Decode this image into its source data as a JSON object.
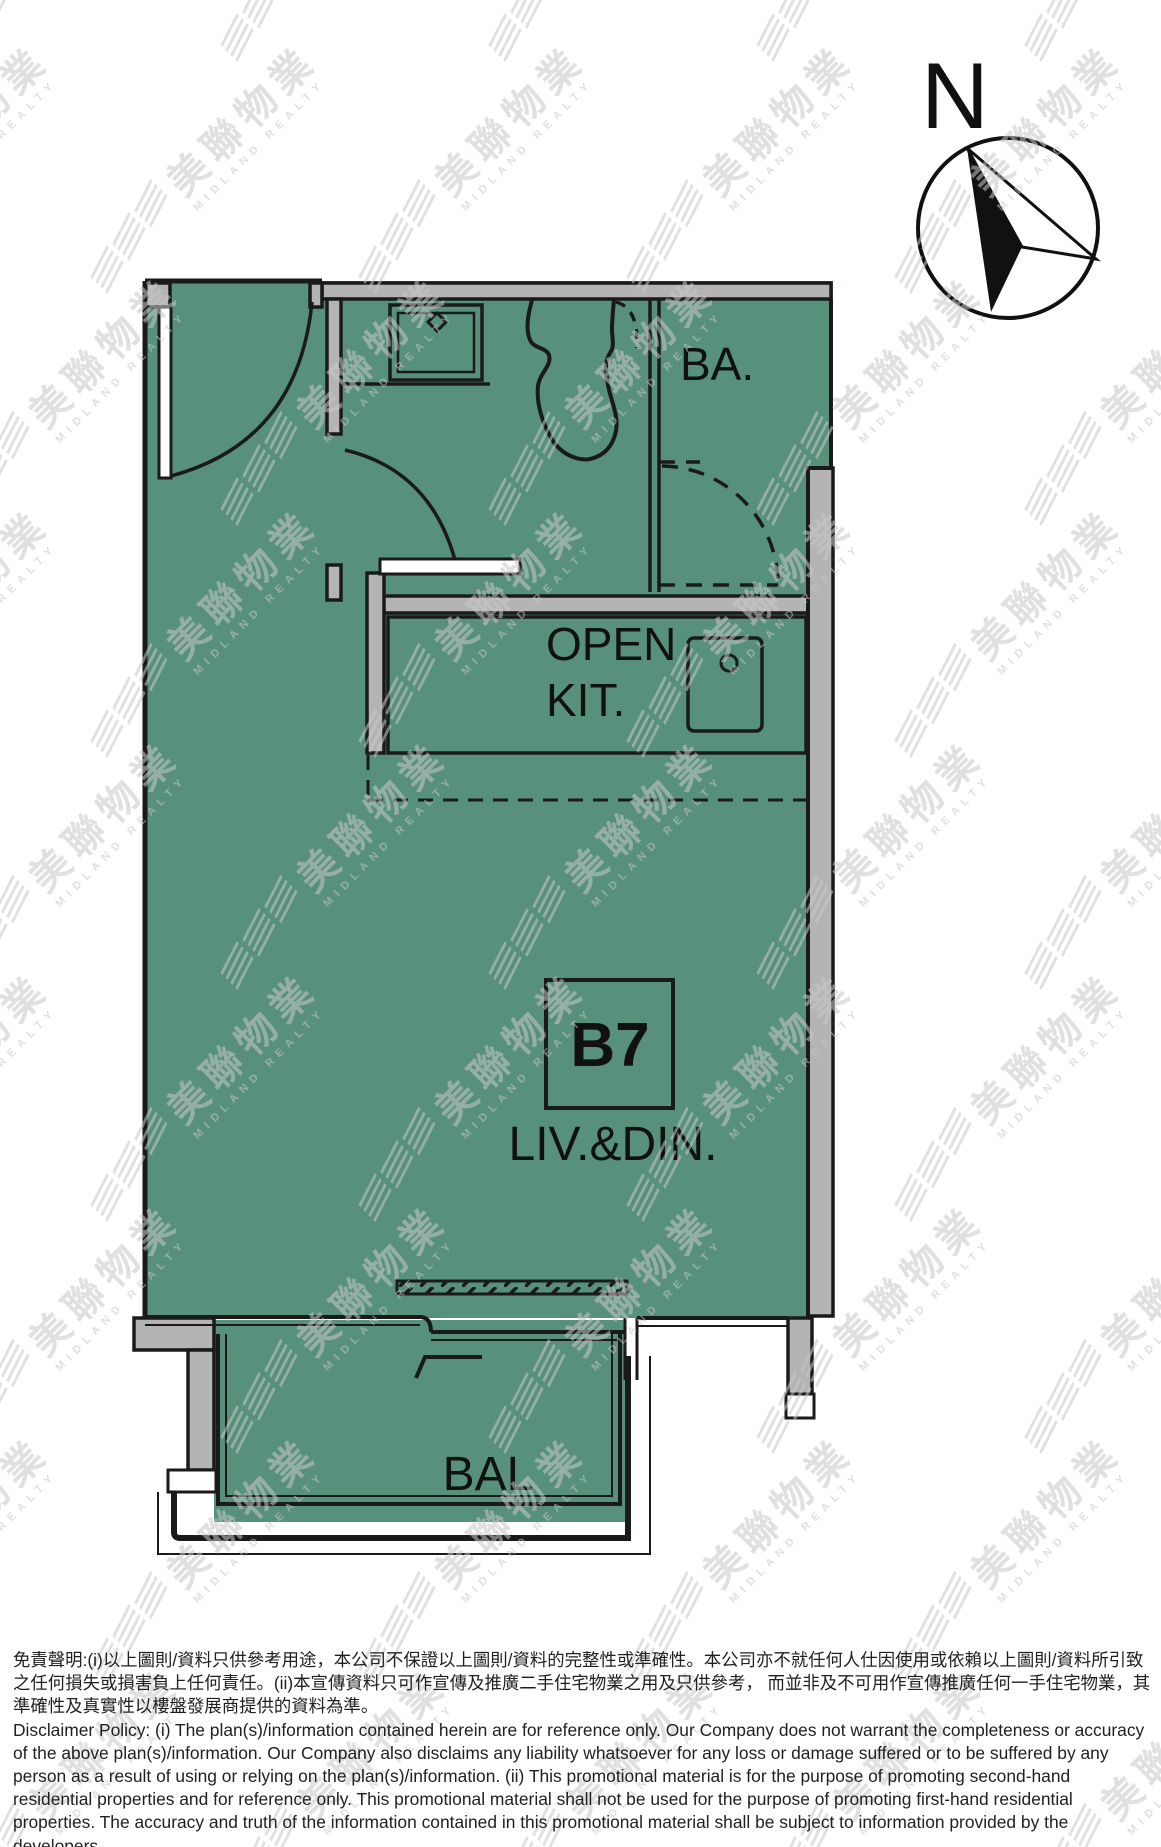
{
  "compass": {
    "north_label": "N"
  },
  "plan": {
    "unit_box_label": "B7",
    "labels": {
      "bathroom": "BA.",
      "kitchen_line1": "OPEN",
      "kitchen_line2": "KIT.",
      "living_dining": "LIV.&DIN.",
      "balcony": "BAL"
    },
    "colors": {
      "floor": "#58917B",
      "wall": "#B4B4B4",
      "line": "#1A1A1A"
    }
  },
  "watermark": {
    "cjk": "美聯物業",
    "latin": "MIDLAND REALTY",
    "color": "#C8C8C8"
  },
  "disclaimer": {
    "zh": "免責聲明:(i)以上圖則/資料只供參考用途，本公司不保證以上圖則/資料的完整性或準確性。本公司亦不就任何人仕因使用或依賴以上圖則/資料所引致之任何損失或損害負上任何責任。(ii)本宣傳資料只可作宣傳及推廣二手住宅物業之用及只供參考， 而並非及不可用作宣傳推廣任何一手住宅物業，其準確性及真實性以樓盤發展商提供的資料為準。",
    "en": "Disclaimer Policy: (i) The plan(s)/information contained herein are for reference only. Our Company does not warrant the completeness or accuracy of the above plan(s)/information. Our Company also disclaims any liability whatsoever for any loss or damage suffered or to be suffered by any person as a result of using or relying on the plan(s)/information. (ii) This promotional material is for the purpose of promoting second-hand residential properties and for reference only. This promotional material shall not be used for the purpose of promoting first-hand residential properties. The accuracy and truth of the information contained in this promotional material shall be subject to information provided by the developers."
  }
}
